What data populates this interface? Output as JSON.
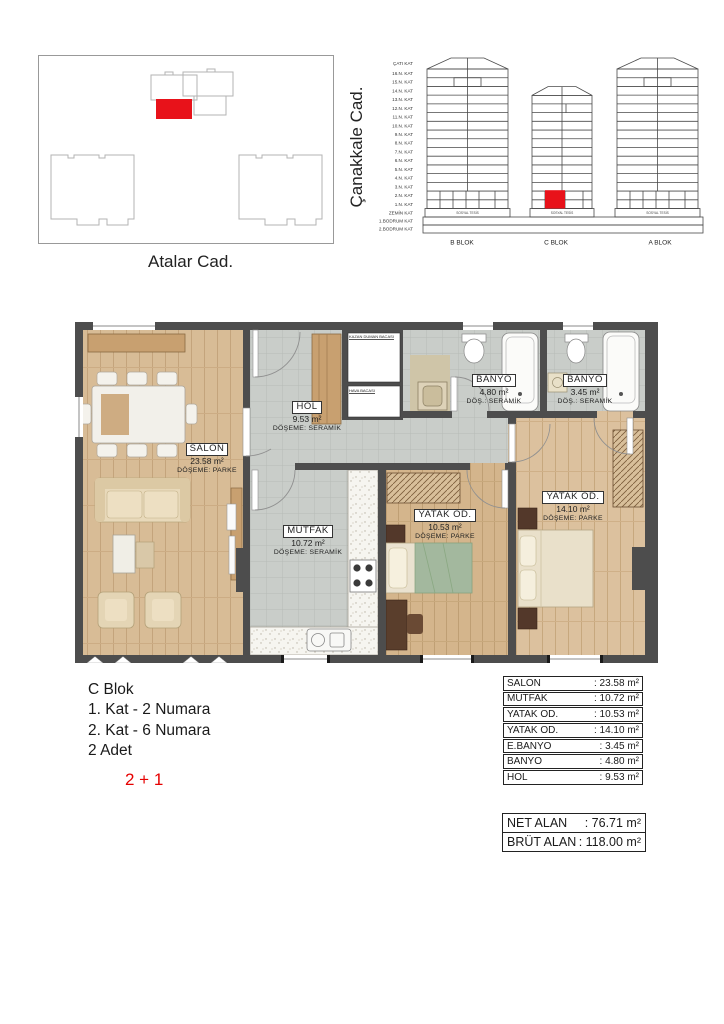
{
  "site_plan": {
    "street_label": "Atalar Cad."
  },
  "elevation": {
    "street_label": "Çanakkale Cad.",
    "floor_labels": [
      "ÇATI KAT",
      "16.N. KAT",
      "15.N. KAT",
      "14.N. KAT",
      "13.N. KAT",
      "12.N. KAT",
      "11.N. KAT",
      "10.N. KAT",
      "9.N. KAT",
      "8.N. KAT",
      "7.N. KAT",
      "6.N. KAT",
      "5.N. KAT",
      "4.N. KAT",
      "3.N. KAT",
      "2.N. KAT",
      "1.N. KAT",
      "ZEMİN KAT",
      "1.BODRUM KAT",
      "2.BODRUM KAT"
    ],
    "ground_floor_label": "SOSYAL TESİS",
    "block_labels": [
      "B BLOK",
      "C BLOK",
      "A BLOK"
    ],
    "highlight_color": "#e8121a"
  },
  "floor_plan": {
    "rooms": {
      "salon": {
        "name": "SALON",
        "area": "23.58 m²",
        "floor": "DÖŞEME: PARKE"
      },
      "hol": {
        "name": "HOL",
        "area": "9.53 m²",
        "floor": "DÖŞEME: SERAMİK"
      },
      "mutfak": {
        "name": "MUTFAK",
        "area": "10.72 m²",
        "floor": "DÖŞEME: SERAMİK"
      },
      "yatak1": {
        "name": "YATAK OD.",
        "area": "10.53 m²",
        "floor": "DÖŞEME: PARKE"
      },
      "yatak2": {
        "name": "YATAK OD.",
        "area": "14.10 m²",
        "floor": "DÖŞEME: PARKE"
      },
      "banyo": {
        "name": "BANYO",
        "area": "4.80 m²",
        "floor": "DÖŞ.: SERAMİK"
      },
      "ebanyo": {
        "name": "BANYO",
        "area": "3.45 m²",
        "floor": "DÖŞ.: SERAMİK"
      }
    },
    "shafts": {
      "kazan": "KAZAN DUMAN BACASI",
      "hava": "HAVA BACASI"
    }
  },
  "info": {
    "block": "C Blok",
    "line1": "1. Kat - 2 Numara",
    "line2": "2. Kat - 6 Numara",
    "line3": "2 Adet",
    "type": "2 + 1",
    "type_color": "#e60000"
  },
  "area_table": {
    "rows": [
      {
        "label": "SALON",
        "value": ": 23.58 m²"
      },
      {
        "label": "MUTFAK",
        "value": ": 10.72 m²"
      },
      {
        "label": "YATAK OD.",
        "value": ": 10.53 m²"
      },
      {
        "label": "YATAK OD.",
        "value": ": 14.10 m²"
      },
      {
        "label": "E.BANYO",
        "value": ": 3.45 m²"
      },
      {
        "label": "BANYO",
        "value": ": 4.80 m²"
      },
      {
        "label": "HOL",
        "value": ": 9.53 m²"
      }
    ],
    "totals": [
      {
        "label": "NET ALAN",
        "value": ": 76.71 m²"
      },
      {
        "label": "BRÜT ALAN",
        "value": ": 118.00 m²"
      }
    ]
  }
}
